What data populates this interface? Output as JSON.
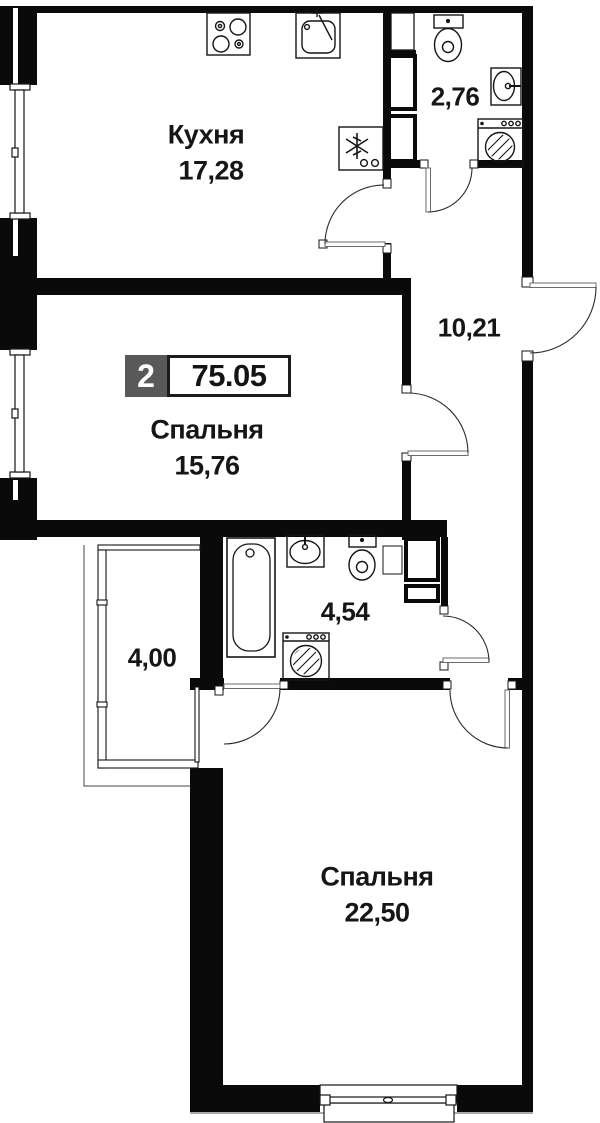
{
  "plan": {
    "badge": {
      "rooms_count": "2",
      "total_area": "75.05"
    },
    "rooms": {
      "kitchen": {
        "name": "Кухня",
        "area": "17,28"
      },
      "bedroom1": {
        "name": "Спальня",
        "area": "15,76"
      },
      "bedroom2": {
        "name": "Спальня",
        "area": "22,50"
      },
      "bathroom_top": {
        "area": "2,76"
      },
      "hallway": {
        "area": "10,21"
      },
      "bathroom_main": {
        "area": "4,54"
      },
      "balcony": {
        "area": "4,00"
      }
    },
    "colors": {
      "wall": "#0a0a0a",
      "badge_gray": "#59595b",
      "text": "#161616"
    }
  }
}
